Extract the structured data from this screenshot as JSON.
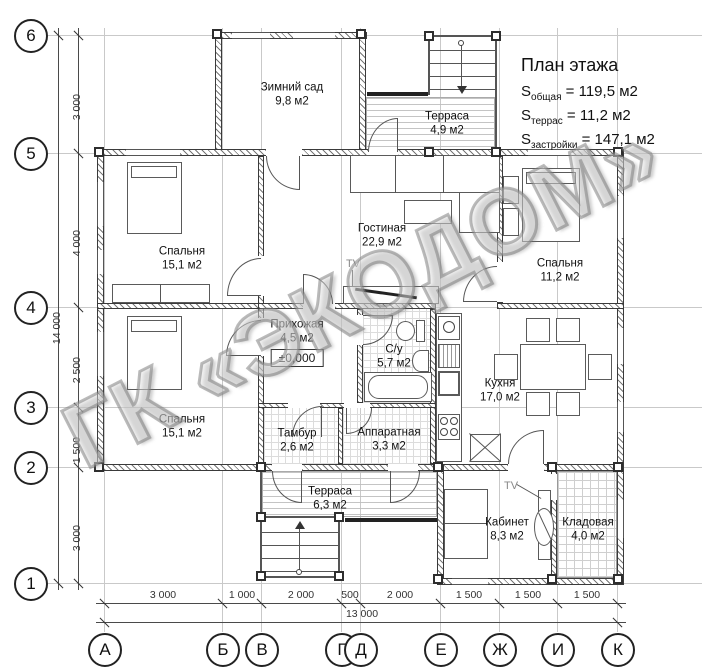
{
  "title_block": {
    "title": "План этажа",
    "lines": [
      {
        "base": "S",
        "sub": "общая",
        "rest": " = 119,5 м2"
      },
      {
        "base": "S",
        "sub": "террас",
        "rest": " = 11,2 м2"
      },
      {
        "base": "S",
        "sub": "застройки",
        "rest": " = 147,1 м2"
      }
    ]
  },
  "watermark": "ГК «ЭКОДОМ»",
  "rooms": [
    {
      "name": "Зимний сад",
      "area": "9,8 м2",
      "x": 292,
      "y": 95
    },
    {
      "name": "Терраса",
      "area": "4,9 м2",
      "x": 447,
      "y": 124
    },
    {
      "name": "Гостиная",
      "area": "22,9 м2",
      "x": 382,
      "y": 236
    },
    {
      "name": "Спальня",
      "area": "15,1 м2",
      "x": 182,
      "y": 259
    },
    {
      "name": "Спальня",
      "area": "11,2 м2",
      "x": 560,
      "y": 271
    },
    {
      "name": "Прихожая",
      "area": "4,5 м2",
      "x": 297,
      "y": 332
    },
    {
      "name": "С/у",
      "area": "5,7 м2",
      "x": 394,
      "y": 357
    },
    {
      "name": "Кухня",
      "area": "17,0 м2",
      "x": 500,
      "y": 391
    },
    {
      "name": "Спальня",
      "area": "15,1 м2",
      "x": 182,
      "y": 427
    },
    {
      "name": "Тамбур",
      "area": "2,6 м2",
      "x": 297,
      "y": 441
    },
    {
      "name": "Аппаратная",
      "area": "3,3 м2",
      "x": 389,
      "y": 440
    },
    {
      "name": "Терраса",
      "area": "6,3 м2",
      "x": 330,
      "y": 499
    },
    {
      "name": "Кабинет",
      "area": "8,3 м2",
      "x": 507,
      "y": 530
    },
    {
      "name": "Кладовая",
      "area": "4,0 м2",
      "x": 588,
      "y": 530
    }
  ],
  "level_mark": {
    "text": "±0,000",
    "x": 297,
    "y": 358
  },
  "tv_labels": [
    {
      "text": "TV",
      "x": 353,
      "y": 264
    },
    {
      "text": "TV",
      "x": 511,
      "y": 486
    }
  ],
  "axes": {
    "left": [
      {
        "label": "6",
        "y": 35
      },
      {
        "label": "5",
        "y": 153
      },
      {
        "label": "4",
        "y": 307
      },
      {
        "label": "3",
        "y": 407
      },
      {
        "label": "2",
        "y": 467
      },
      {
        "label": "1",
        "y": 583
      }
    ],
    "bottom": [
      {
        "label": "А",
        "x": 104
      },
      {
        "label": "Б",
        "x": 222
      },
      {
        "label": "В",
        "x": 261
      },
      {
        "label": "Г",
        "x": 341
      },
      {
        "label": "Д",
        "x": 360
      },
      {
        "label": "Е",
        "x": 440
      },
      {
        "label": "Ж",
        "x": 499
      },
      {
        "label": "И",
        "x": 557
      },
      {
        "label": "К",
        "x": 617
      }
    ]
  },
  "dimensions": {
    "bottom": {
      "segments": [
        {
          "text": "3 000",
          "x": 163
        },
        {
          "text": "1 000",
          "x": 242
        },
        {
          "text": "2 000",
          "x": 301
        },
        {
          "text": "500",
          "x": 350
        },
        {
          "text": "2 000",
          "x": 400
        },
        {
          "text": "1 500",
          "x": 469
        },
        {
          "text": "1 500",
          "x": 528
        },
        {
          "text": "1 500",
          "x": 587
        }
      ],
      "total": {
        "text": "13 000",
        "x": 362
      }
    },
    "left": {
      "segments": [
        {
          "text": "3 000",
          "y": 94
        },
        {
          "text": "4 000",
          "y": 230
        },
        {
          "text": "2 500",
          "y": 357
        },
        {
          "text": "1 500",
          "y": 437
        },
        {
          "text": "3 000",
          "y": 525
        }
      ],
      "total": {
        "text": "14 000",
        "y": 312
      }
    }
  },
  "colors": {
    "line": "#3a3a3a",
    "grid": "#c9c9c9",
    "watermark": "#9a9a9a"
  }
}
